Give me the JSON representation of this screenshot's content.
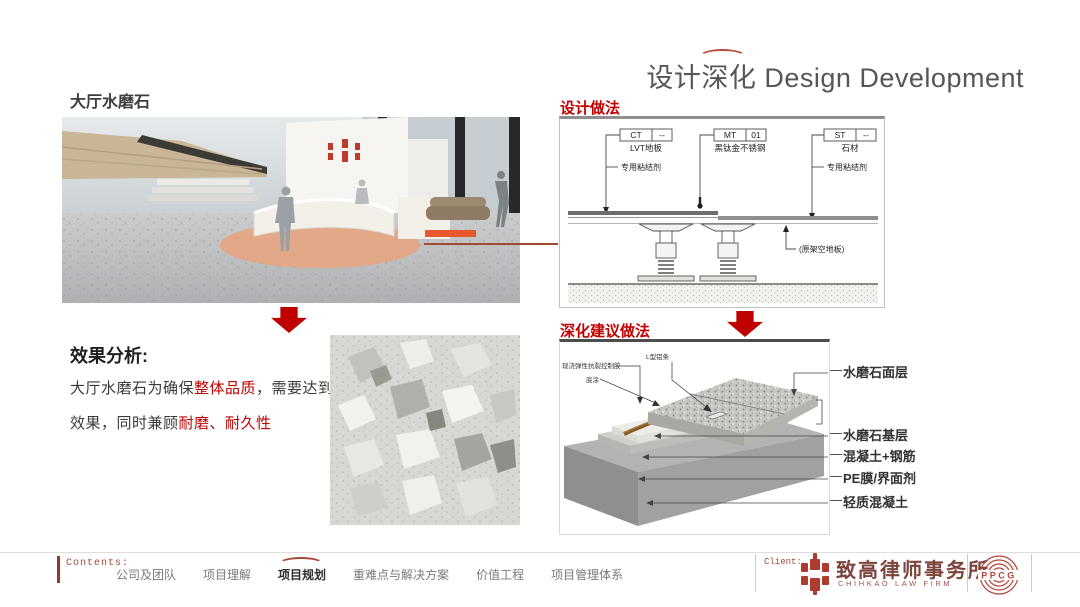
{
  "header": {
    "title_zh": "设计深化",
    "title_en": "Design Development"
  },
  "section": {
    "heading": "大厅水磨石"
  },
  "design_method": {
    "label": "设计做法",
    "tags": [
      {
        "code": "CT",
        "num": "--",
        "material": "LVT地板"
      },
      {
        "code": "MT",
        "num": "01",
        "material": "黑钛金不锈钢"
      },
      {
        "code": "ST",
        "num": "--",
        "material": "石材"
      }
    ],
    "adhesive_left": "专用粘结剂",
    "adhesive_right": "专用粘结剂",
    "floor_note": "(原架空地板)"
  },
  "suggestion": {
    "label": "深化建议做法",
    "callouts": [
      "现浇弹性抗裂控制胶",
      "底涂",
      "L型铝条"
    ],
    "layers": [
      "水磨石面层",
      "水磨石基层",
      "混凝土+钢筋",
      "PE膜/界面剂",
      "轻质混凝土"
    ]
  },
  "analysis": {
    "heading": "效果分析:",
    "line1": [
      {
        "t": "大厅水磨石为确保"
      },
      {
        "t": "整体品质",
        "red": true
      },
      {
        "t": "，需要达到"
      },
      {
        "t": "无缝",
        "red": true
      }
    ],
    "line2": [
      {
        "t": "效果，同时兼顾"
      },
      {
        "t": "耐磨、耐久性",
        "red": true
      }
    ]
  },
  "footer": {
    "contents_label": "Contents:",
    "nav": [
      {
        "label": "公司及团队"
      },
      {
        "label": "项目理解"
      },
      {
        "label": "项目规划",
        "active": true
      },
      {
        "label": "重难点与解决方案"
      },
      {
        "label": "价值工程"
      },
      {
        "label": "项目管理体系"
      }
    ],
    "client_label": "Client:",
    "client_name": "致高律师事务所",
    "client_name_en": "CHIHKAO LAW FIRM",
    "partner": "PPCG"
  },
  "colors": {
    "accent_red": "#c00000",
    "brand_red": "#a84a38",
    "orange_marker": "#e7592c"
  }
}
